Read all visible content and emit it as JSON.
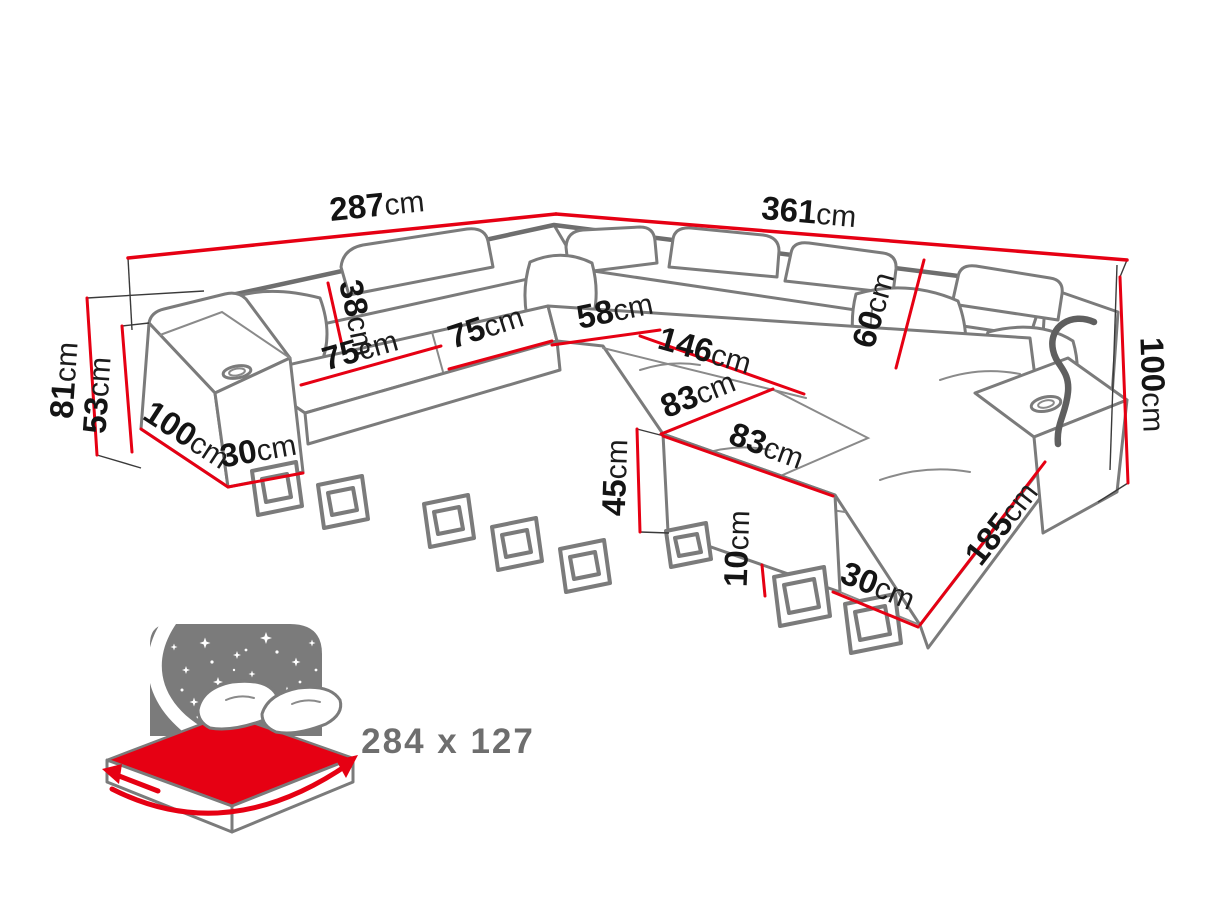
{
  "diagram": {
    "type": "corner-sofa-dimension-diagram",
    "colors": {
      "dimension_line_red": "#e60013",
      "sketch_outline_gray": "#7b7b7b",
      "dimension_text": "#141414",
      "sleeping_size_text": "#6e6e6e"
    },
    "dims": {
      "back_width_left": {
        "value": "287",
        "unit": "cm"
      },
      "back_width_right": {
        "value": "361",
        "unit": "cm"
      },
      "total_height": {
        "value": "81",
        "unit": "cm"
      },
      "armrest_height": {
        "value": "53",
        "unit": "cm"
      },
      "side_depth": {
        "value": "100",
        "unit": "cm"
      },
      "armrest_foot": {
        "value": "30",
        "unit": "cm"
      },
      "headrest_height": {
        "value": "38",
        "unit": "cm"
      },
      "seat1_width": {
        "value": "75",
        "unit": "cm"
      },
      "seat2_width": {
        "value": "75",
        "unit": "cm"
      },
      "corner_seat_width": {
        "value": "58",
        "unit": "cm"
      },
      "right_seat_width": {
        "value": "146",
        "unit": "cm"
      },
      "backrest_height": {
        "value": "60",
        "unit": "cm"
      },
      "chaise_top_width": {
        "value": "83",
        "unit": "cm"
      },
      "chaise_front_width": {
        "value": "83",
        "unit": "cm"
      },
      "right_total_height": {
        "value": "100",
        "unit": "cm"
      },
      "chaise_front_height": {
        "value": "45",
        "unit": "cm"
      },
      "leg_height": {
        "value": "10",
        "unit": "cm"
      },
      "chaise_foot_depth": {
        "value": "30",
        "unit": "cm"
      },
      "chaise_length": {
        "value": "185",
        "unit": "cm"
      }
    },
    "sleeping_function": {
      "icon": "sofa-bed-night-icon",
      "size_label": "284 x 127"
    }
  }
}
